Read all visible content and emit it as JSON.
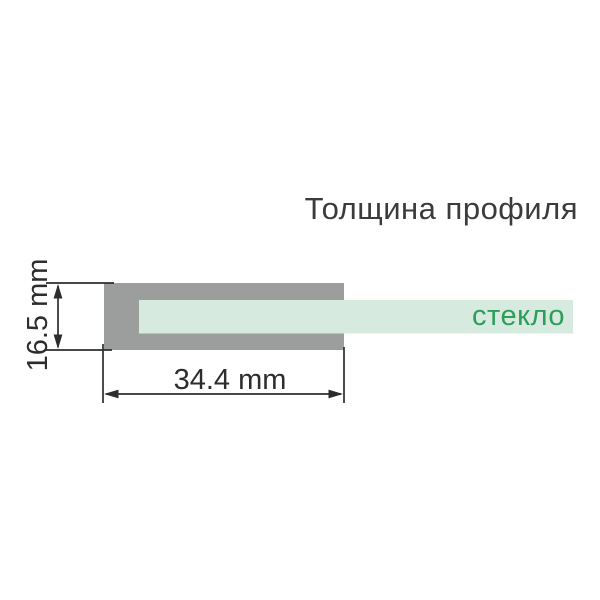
{
  "title": "Толщина профиля",
  "diagram": {
    "glass_label": "стекло",
    "profile_width_mm": 34.4,
    "profile_height_mm": 16.5,
    "dimensions": {
      "height_label": "16.5 mm",
      "width_label": "34.4 mm"
    }
  },
  "colors": {
    "bg": "#ffffff",
    "title_text": "#3b3b3b",
    "profile_gray": "#9b9e9c",
    "glass_fill": "#d7eae0",
    "glass_label_green": "#2d9e59",
    "dimension_line": "#2d2d2d"
  }
}
